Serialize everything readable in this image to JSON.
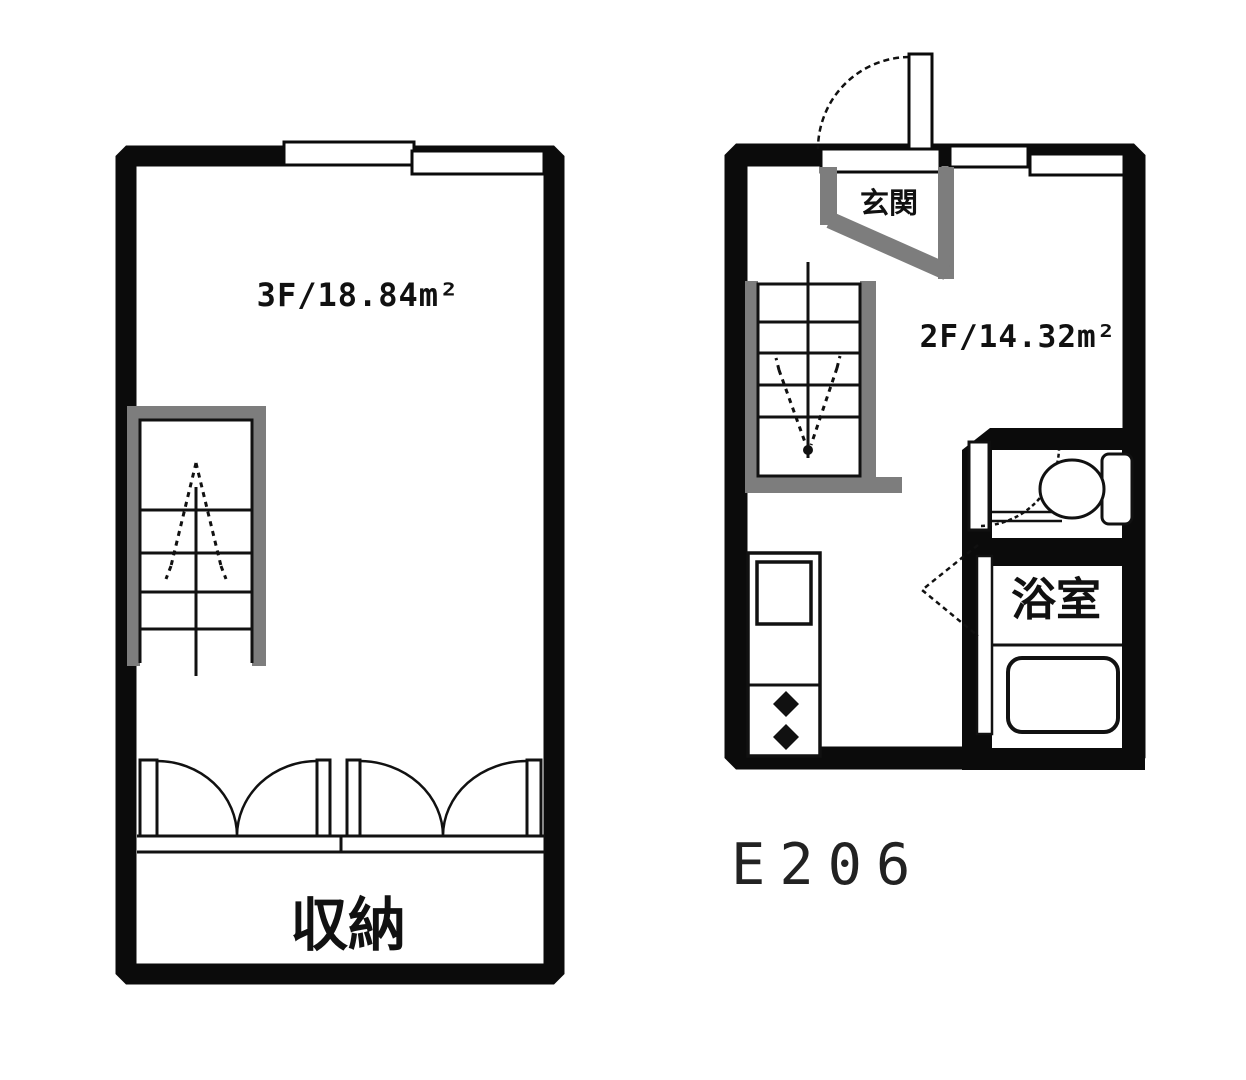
{
  "document": {
    "type": "apartment floor plan (maisonette, 2F/3F)",
    "unit_number": "E206"
  },
  "floor3": {
    "floor_name": "3F",
    "area_sqm": 18.84,
    "area_label": "3F/18.84m²",
    "storage_label": "収納"
  },
  "floor2": {
    "floor_name": "2F",
    "area_sqm": 14.32,
    "area_label": "2F/14.32m²",
    "entrance_label": "玄関",
    "bathroom_label": "浴室"
  },
  "colors": {
    "wall": "#0b0b0b",
    "fixture_gray": "#7d7d7d",
    "background": "#ffffff"
  }
}
